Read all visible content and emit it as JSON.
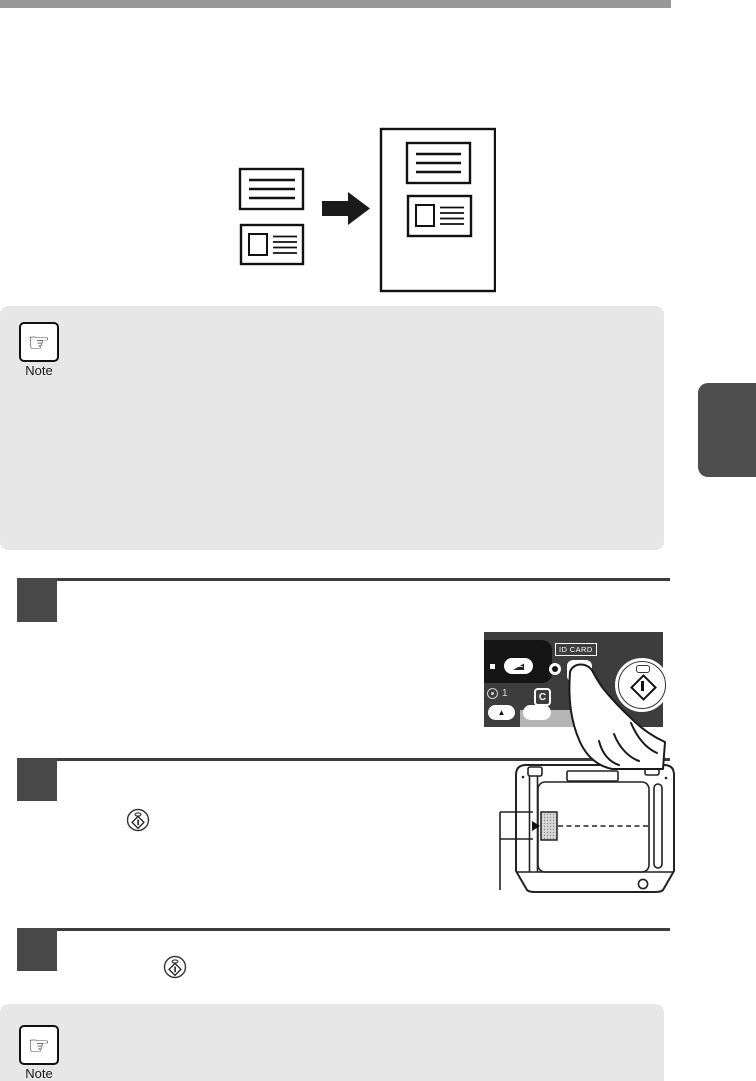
{
  "page": {
    "colors": {
      "top_bar": "#999999",
      "note_background": "#e7e7e7",
      "side_tab": "#4d4d4d",
      "step_marker": "#484848",
      "panel_background": "#3d3d3d",
      "panel_strip": "#b5b5b5"
    }
  },
  "top_note": {
    "label": "Note"
  },
  "bottom_note": {
    "label": "Note"
  },
  "icons": {
    "note_hand_glyph": "☞"
  },
  "steps": [
    {
      "marker_text": ""
    },
    {
      "marker_text": ""
    },
    {
      "marker_text": ""
    }
  ],
  "control_panel": {
    "id_card_label": "ID CARD",
    "copies_value": "1",
    "clear_key_label": "C",
    "up_key_label": "▲"
  }
}
